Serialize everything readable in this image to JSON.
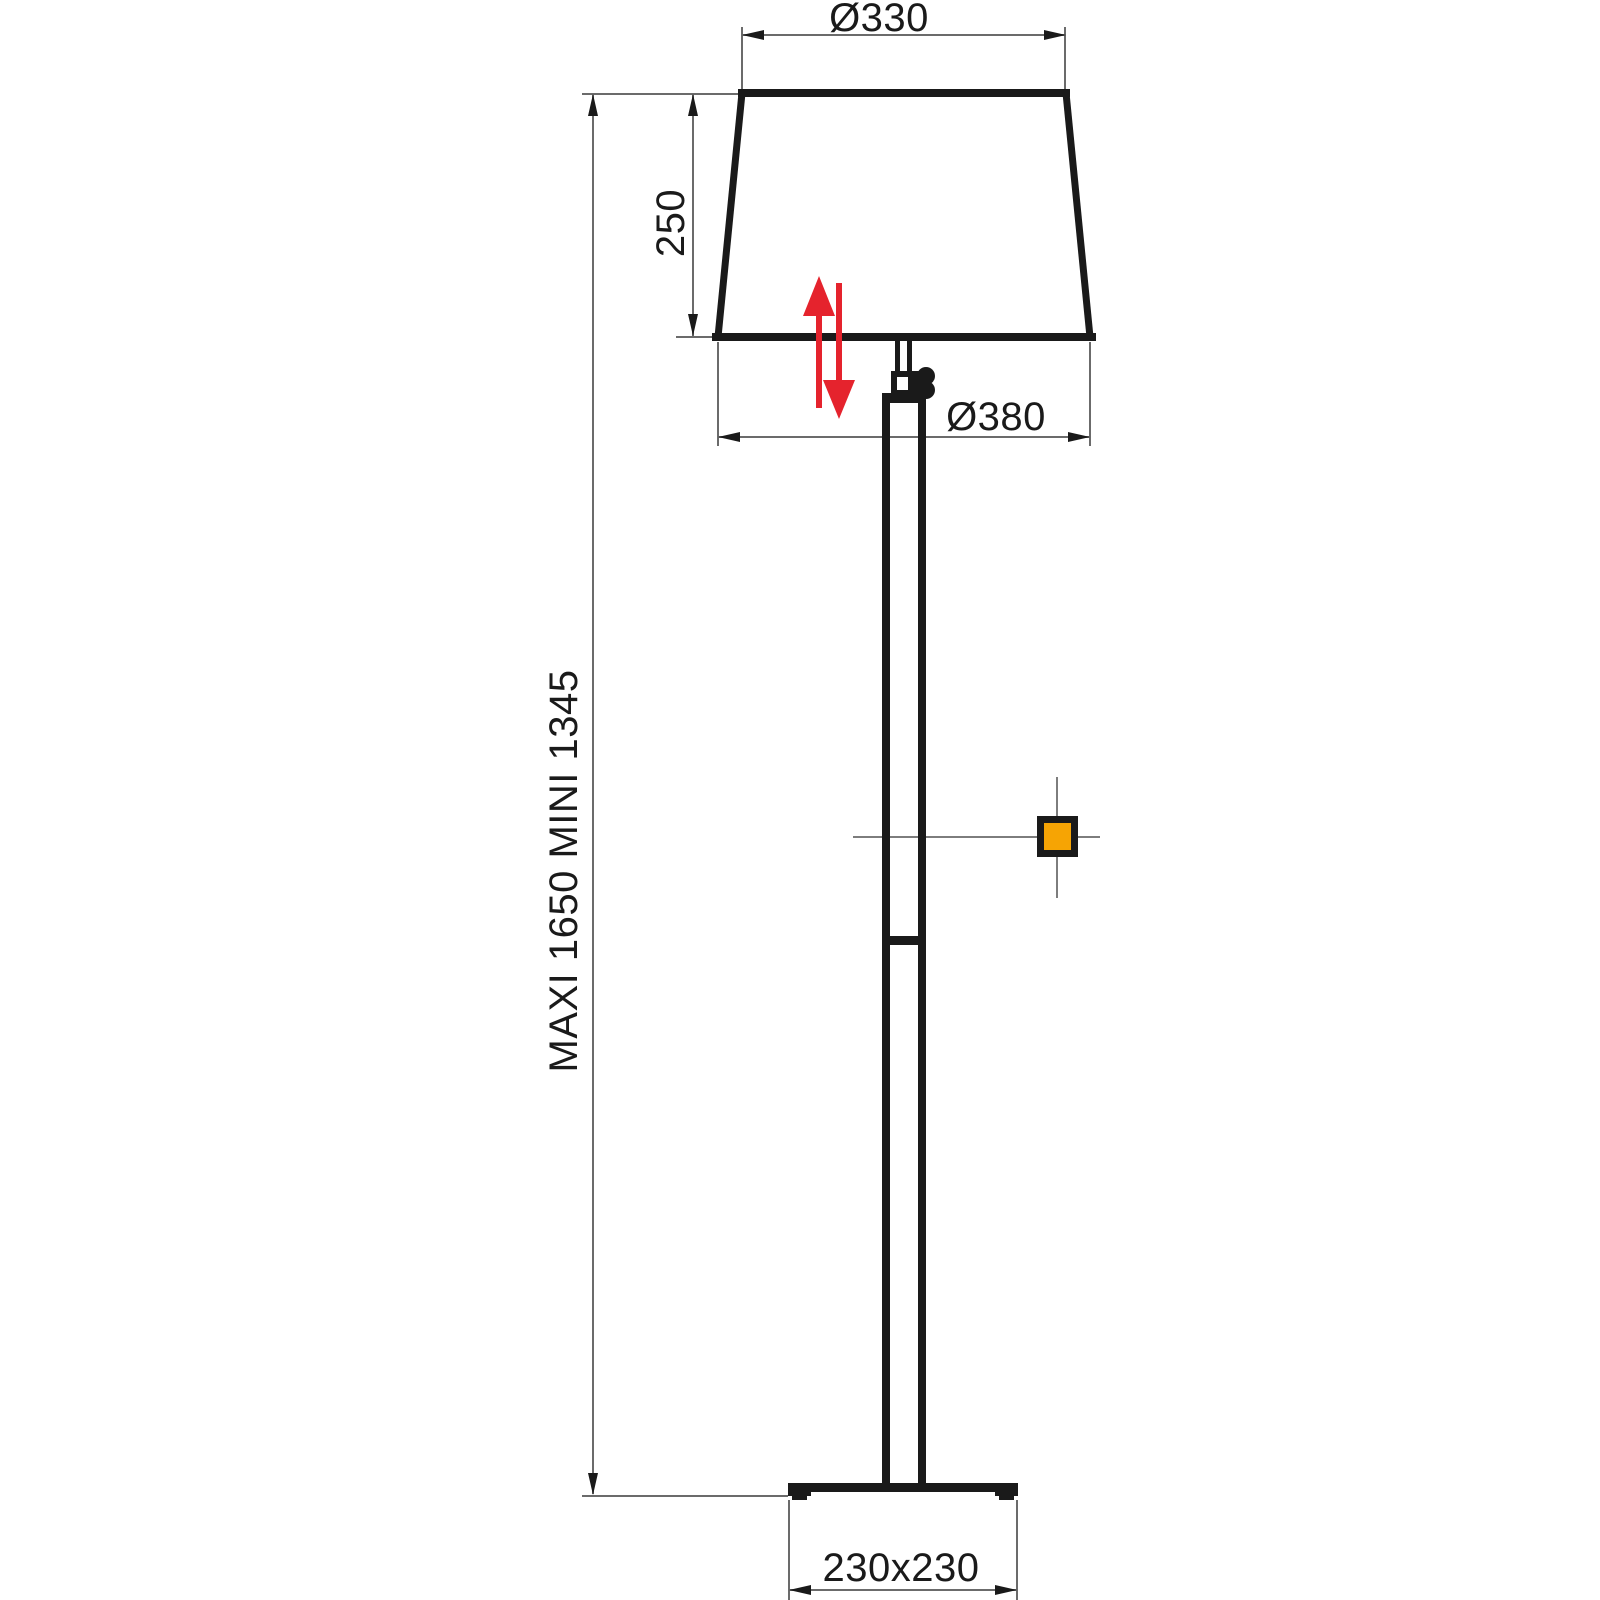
{
  "labels": {
    "shade_top_diameter": "Ø330",
    "shade_height": "250",
    "shade_bottom_diameter": "Ø380",
    "overall_height": "MAXI 1650 MINI 1345",
    "base_footprint": "230x230"
  },
  "colors": {
    "line_black": "#1a1a1a",
    "dimension_gray": "#6b6b6b",
    "crosshair_gray": "#7d7d7d",
    "adjust_arrow_red": "#e5232d",
    "switch_orange": "#f6a404",
    "background": "#ffffff"
  }
}
